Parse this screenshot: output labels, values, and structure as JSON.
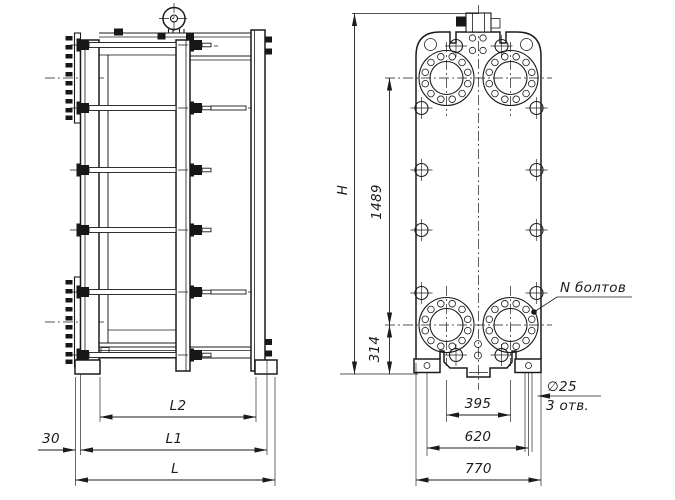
{
  "app": {
    "type": "technical-drawing",
    "subject": "plate-heat-exchanger",
    "background_color": "#ffffff",
    "ink_color": "#1b1b1d"
  },
  "side_view": {
    "dims": {
      "offset30": "30",
      "L2": "L2",
      "L1": "L1",
      "L": "L"
    }
  },
  "front_view": {
    "dims": {
      "H": "H",
      "v1489": "1489",
      "v314": "314",
      "v395": "395",
      "v620": "620",
      "v770": "770"
    },
    "callouts": {
      "n_bolts": "N болтов",
      "hole_dia": "∅25",
      "hole_count": "3 отв."
    }
  }
}
